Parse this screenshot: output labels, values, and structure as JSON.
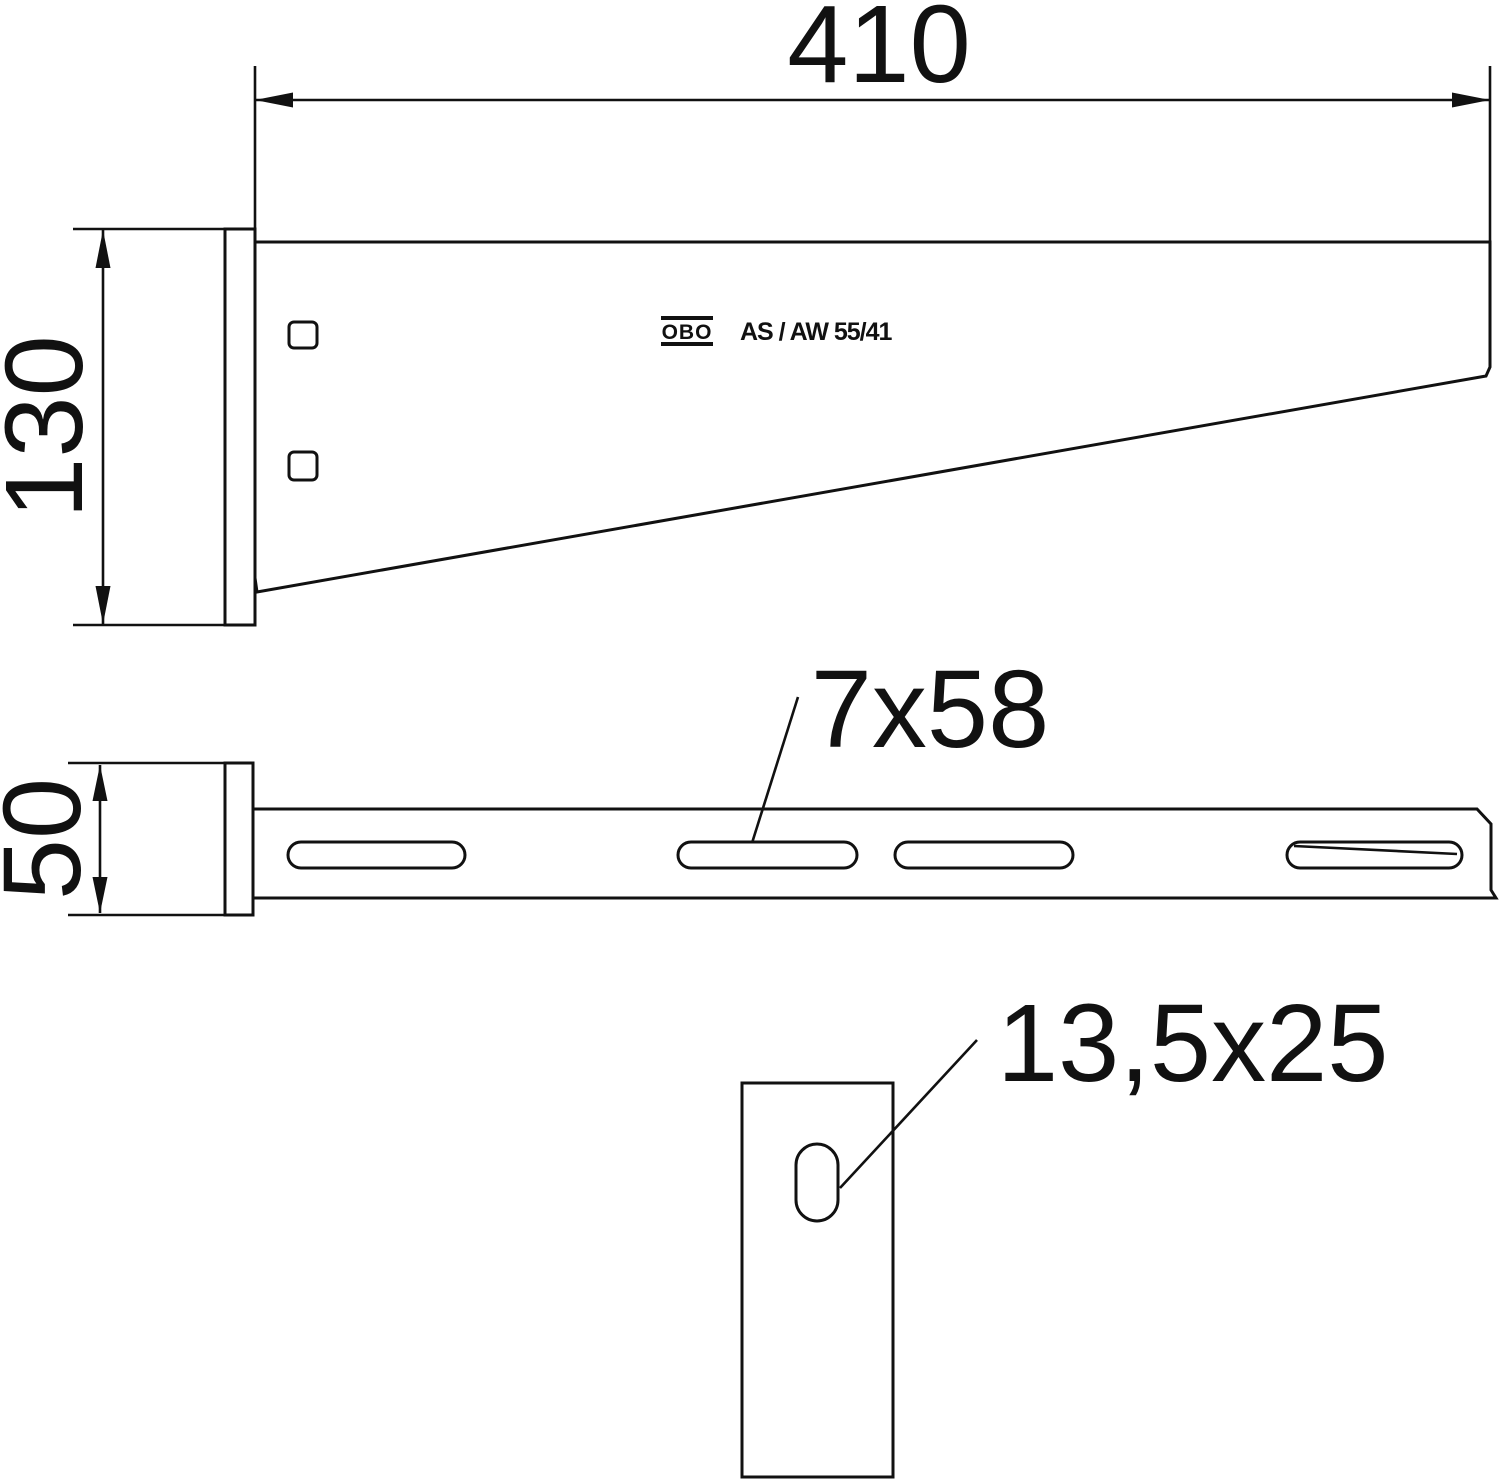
{
  "drawing": {
    "title": "Wall and support bracket dimensional drawing",
    "labels": {
      "length_dim": "410",
      "height_dim": "130",
      "width_dim": "50",
      "slot_dim": "7x58",
      "hole_dim": "13,5x25",
      "brand": "OBO",
      "model": "AS / AW 55/41"
    },
    "colors": {
      "line": "#111111",
      "background": "#ffffff"
    }
  }
}
